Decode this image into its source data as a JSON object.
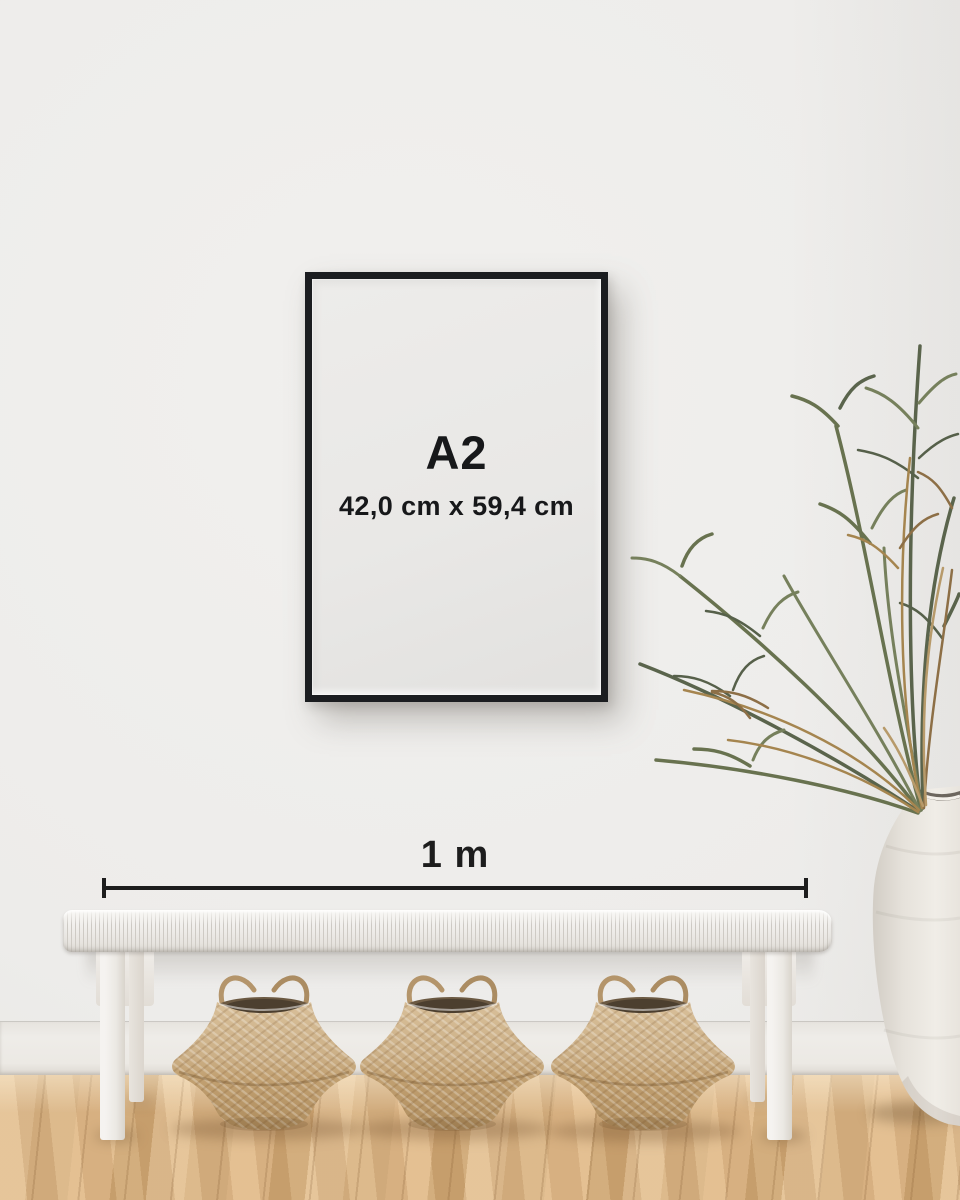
{
  "scene": {
    "poster": {
      "size_label": "A2",
      "dimensions_label": "42,0 cm x 59,4 cm"
    },
    "measure": {
      "label": "1 m"
    }
  },
  "colors": {
    "wall": "#edecea",
    "baseboard": "#eeece8",
    "floor-light": "#e2c094",
    "floor-mid": "#d8b384",
    "floor-dark": "#cda573",
    "frame": "#1b1d20",
    "poster-bg": "#e9e8e6",
    "ink": "#17181a",
    "measure-ink": "#1d1d1d",
    "bench": "#f2f0ed",
    "basket": "#c9ac81",
    "basket-dark": "#a9895c",
    "plant-green": "#67714f",
    "plant-brown": "#9a7c50",
    "vase": "#eae6e0"
  }
}
